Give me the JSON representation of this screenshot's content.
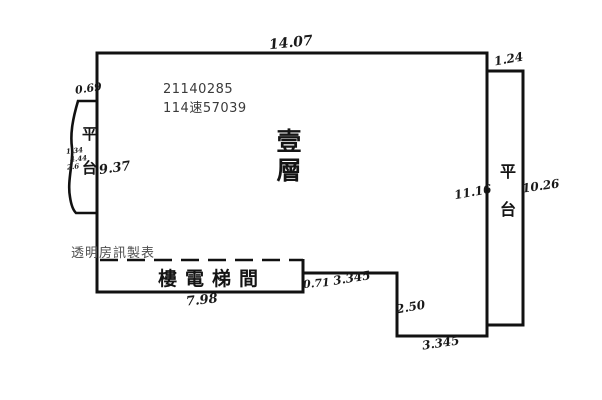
{
  "labels": {
    "ref_number_1": "21140285",
    "ref_number_2": "114速57039",
    "floor": "壹層",
    "left_platform": "平台",
    "right_platform": "平台",
    "stair_elevator_room": "樓電梯間",
    "watermark": "透明房訊製表"
  },
  "dimensions": {
    "top_width": "14.07",
    "right_platform_width": "1.24",
    "left_platform_width": "0.69",
    "left_wall_height": "9.37",
    "right_wall_height": "11.16",
    "right_platform_height": "10.26",
    "stair_room_width": "7.98",
    "notch_offset": "0.71",
    "notch_width": "3.345",
    "notch_height": "2.50",
    "bottom_right_width": "3.345",
    "left_edge_scribbles": [
      "1.34",
      "4.44",
      "2.6"
    ]
  },
  "colors": {
    "line": "#111111",
    "watermark_text": "#4f4f4f",
    "paper": "#ffffff"
  }
}
